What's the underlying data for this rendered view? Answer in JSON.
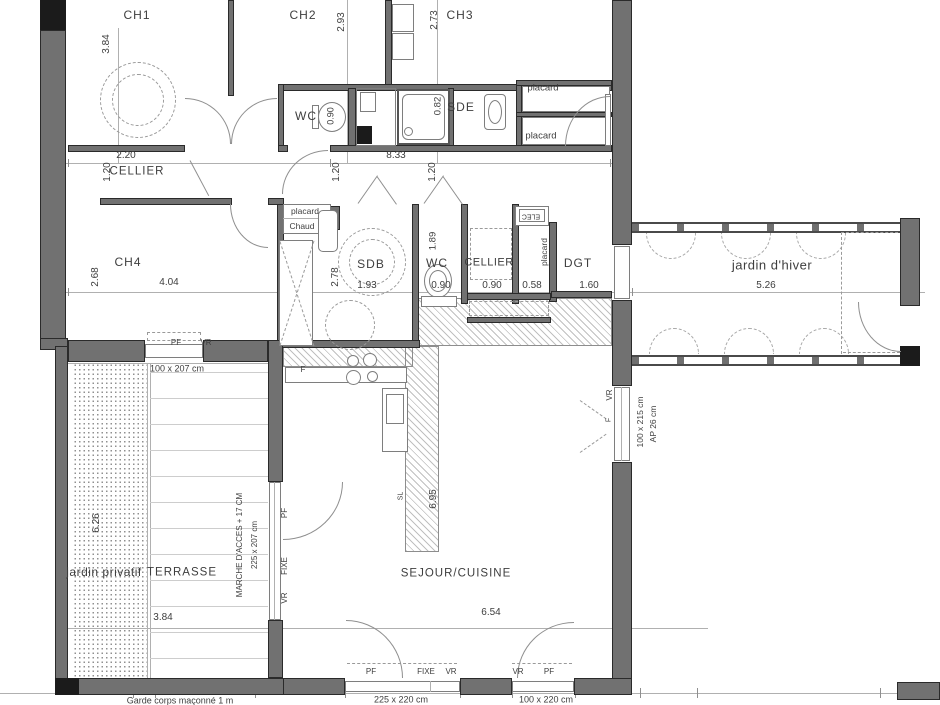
{
  "colors": {
    "wall": "#717171",
    "wall_dark": "#1b1b1b",
    "line": "#b0b0b0",
    "text": "#3e3e3e",
    "background": "#ffffff"
  },
  "plan": {
    "rooms": [
      {
        "n": "room-label-ch1",
        "t": "CH1",
        "x": 137,
        "y": 15,
        "s": 12,
        "ls": 1
      },
      {
        "n": "room-label-ch2",
        "t": "CH2",
        "x": 303,
        "y": 15,
        "s": 12,
        "ls": 1
      },
      {
        "n": "room-label-ch3",
        "t": "CH3",
        "x": 460,
        "y": 15,
        "s": 12,
        "ls": 1
      },
      {
        "n": "room-label-wc-top",
        "t": "WC",
        "x": 306,
        "y": 116,
        "s": 12,
        "ls": 1
      },
      {
        "n": "room-label-sde",
        "t": "SDE",
        "x": 461,
        "y": 107,
        "s": 12,
        "ls": 1
      },
      {
        "n": "room-label-cellier-top",
        "t": "CELLIER",
        "x": 137,
        "y": 172,
        "s": 11.5,
        "ls": 1
      },
      {
        "n": "room-label-ch4",
        "t": "CH4",
        "x": 128,
        "y": 262,
        "s": 12,
        "ls": 1
      },
      {
        "n": "room-label-sdb",
        "t": "SDB",
        "x": 371,
        "y": 264,
        "s": 12,
        "ls": 1
      },
      {
        "n": "room-label-wc-mid",
        "t": "WC",
        "x": 437,
        "y": 263,
        "s": 12,
        "ls": 1
      },
      {
        "n": "room-label-cellier-mid",
        "t": "CELLIER",
        "x": 489,
        "y": 263,
        "s": 11,
        "ls": 0.5
      },
      {
        "n": "room-label-dgt",
        "t": "DGT",
        "x": 578,
        "y": 263,
        "s": 12,
        "ls": 1
      },
      {
        "n": "room-label-jardin-dhiver",
        "t": "jardin d'hiver",
        "x": 772,
        "y": 265,
        "s": 13,
        "ls": 0.5
      },
      {
        "n": "room-label-jardin-privatif",
        "t": "jardin privatif",
        "x": 104,
        "y": 572,
        "s": 12,
        "ls": 0.5
      },
      {
        "n": "room-label-terrasse",
        "t": "TERRASSE",
        "x": 182,
        "y": 573,
        "s": 11.5,
        "ls": 1
      },
      {
        "n": "room-label-sejour-cuisine",
        "t": "SEJOUR/CUISINE",
        "x": 456,
        "y": 574,
        "s": 11.5,
        "ls": 1
      }
    ],
    "closets": [
      {
        "n": "closet-label-placard-1",
        "t": "placard",
        "x": 543,
        "y": 88,
        "s": 9.5
      },
      {
        "n": "closet-label-placard-2",
        "t": "placard",
        "x": 541,
        "y": 136,
        "s": 9.5
      },
      {
        "n": "closet-label-placard-3",
        "t": "placard",
        "x": 305,
        "y": 211,
        "s": 8.5
      },
      {
        "n": "closet-label-chaud",
        "t": "Chaud",
        "x": 302,
        "y": 226,
        "s": 8.5
      },
      {
        "n": "closet-label-placard-4",
        "t": "placard",
        "x": 544,
        "y": 252,
        "s": 8.5,
        "r": -90
      },
      {
        "n": "closet-label-elec",
        "t": "ELEC",
        "x": 531,
        "y": 216,
        "s": 7,
        "r": 180
      }
    ],
    "dimensions": [
      {
        "n": "dim-3-84-top",
        "t": "3.84",
        "x": 107,
        "y": 44,
        "r": -90
      },
      {
        "n": "dim-2-93",
        "t": "2.93",
        "x": 342,
        "y": 22,
        "r": -90
      },
      {
        "n": "dim-2-73",
        "t": "2.73",
        "x": 435,
        "y": 20,
        "r": -90
      },
      {
        "n": "dim-0-90-wc-top",
        "t": "0.90",
        "x": 331,
        "y": 116,
        "r": -90,
        "s": 9
      },
      {
        "n": "dim-0-82",
        "t": "0.82",
        "x": 438,
        "y": 106,
        "r": -90,
        "s": 9.5
      },
      {
        "n": "dim-2-20",
        "t": "2.20",
        "x": 126,
        "y": 156
      },
      {
        "n": "dim-8-33",
        "t": "8.33",
        "x": 396,
        "y": 156
      },
      {
        "n": "dim-1-20-a",
        "t": "1.20",
        "x": 108,
        "y": 172,
        "r": -90
      },
      {
        "n": "dim-1-20-b",
        "t": "1.20",
        "x": 337,
        "y": 172,
        "r": -90
      },
      {
        "n": "dim-1-20-c",
        "t": "1.20",
        "x": 433,
        "y": 172,
        "r": -90
      },
      {
        "n": "dim-2-68",
        "t": "2.68",
        "x": 96,
        "y": 277,
        "r": -90
      },
      {
        "n": "dim-4-04",
        "t": "4.04",
        "x": 169,
        "y": 283
      },
      {
        "n": "dim-2-78",
        "t": "2.78",
        "x": 336,
        "y": 277,
        "r": -90
      },
      {
        "n": "dim-1-93",
        "t": "1.93",
        "x": 367,
        "y": 286
      },
      {
        "n": "dim-1-89",
        "t": "1.89",
        "x": 433,
        "y": 241,
        "r": -90,
        "s": 9.5
      },
      {
        "n": "dim-0-90-b",
        "t": "0.90",
        "x": 441,
        "y": 286
      },
      {
        "n": "dim-0-90-c",
        "t": "0.90",
        "x": 492,
        "y": 286
      },
      {
        "n": "dim-0-58",
        "t": "0.58",
        "x": 532,
        "y": 286
      },
      {
        "n": "dim-1-60",
        "t": "1.60",
        "x": 589,
        "y": 286
      },
      {
        "n": "dim-5-26",
        "t": "5.26",
        "x": 766,
        "y": 286
      },
      {
        "n": "dim-6-26",
        "t": "6.26",
        "x": 97,
        "y": 523,
        "r": -90
      },
      {
        "n": "dim-3-84-bottom",
        "t": "3.84",
        "x": 163,
        "y": 618
      },
      {
        "n": "dim-6-95",
        "t": "6.95",
        "x": 434,
        "y": 499,
        "r": -90
      },
      {
        "n": "dim-6-54",
        "t": "6.54",
        "x": 491,
        "y": 613
      }
    ],
    "openings": [
      {
        "n": "opening-label-pf-1",
        "t": "PF",
        "x": 176,
        "y": 343,
        "s": 8
      },
      {
        "n": "opening-label-vr-1",
        "t": "VR",
        "x": 206,
        "y": 343,
        "s": 8
      },
      {
        "n": "opening-size-100x207",
        "t": "100 x 207 cm",
        "x": 177,
        "y": 369,
        "s": 9
      },
      {
        "n": "annotation-marche-acces",
        "t": "MARCHE D'ACCES + 17 CM",
        "x": 240,
        "y": 545,
        "r": -90,
        "s": 8
      },
      {
        "n": "opening-size-225x207",
        "t": "225 x 207 cm",
        "x": 255,
        "y": 545,
        "r": -90,
        "s": 8
      },
      {
        "n": "opening-label-pf-v",
        "t": "PF",
        "x": 285,
        "y": 513,
        "r": -90,
        "s": 8
      },
      {
        "n": "opening-label-fixe-v",
        "t": "FIXE",
        "x": 285,
        "y": 566,
        "r": -90,
        "s": 8
      },
      {
        "n": "opening-label-vr-v",
        "t": "VR",
        "x": 285,
        "y": 598,
        "r": -90,
        "s": 8
      },
      {
        "n": "opening-label-vr-window",
        "t": "VR",
        "x": 610,
        "y": 395,
        "r": -90,
        "s": 8
      },
      {
        "n": "opening-label-f-window",
        "t": "F",
        "x": 609,
        "y": 420,
        "r": -90,
        "s": 7
      },
      {
        "n": "opening-size-100x215",
        "t": "100 x 215 cm",
        "x": 640,
        "y": 422,
        "r": -90,
        "s": 8.5
      },
      {
        "n": "opening-size-ap-26",
        "t": "AP 26 cm",
        "x": 653,
        "y": 424,
        "r": -90,
        "s": 8.5
      },
      {
        "n": "opening-label-pf-2",
        "t": "PF",
        "x": 371,
        "y": 672,
        "s": 8
      },
      {
        "n": "opening-label-fixe-2",
        "t": "FIXE",
        "x": 426,
        "y": 672,
        "s": 8
      },
      {
        "n": "opening-label-vr-2",
        "t": "VR",
        "x": 451,
        "y": 672,
        "s": 8
      },
      {
        "n": "opening-label-vr-3",
        "t": "VR",
        "x": 518,
        "y": 672,
        "s": 8
      },
      {
        "n": "opening-label-pf-3",
        "t": "PF",
        "x": 549,
        "y": 672,
        "s": 8
      },
      {
        "n": "opening-size-225x220",
        "t": "225 x 220 cm",
        "x": 401,
        "y": 700,
        "s": 9
      },
      {
        "n": "opening-size-100x220",
        "t": "100 x 220 cm",
        "x": 546,
        "y": 700,
        "s": 9
      }
    ],
    "annotations": [
      {
        "n": "annotation-f-fridge",
        "t": "F",
        "x": 303,
        "y": 370,
        "s": 8
      },
      {
        "n": "annotation-sl",
        "t": "SL",
        "x": 401,
        "y": 496,
        "r": -90,
        "s": 7
      },
      {
        "n": "annotation-garde-corps",
        "t": "Garde corps maçonné 1 m",
        "x": 180,
        "y": 701,
        "s": 9
      }
    ]
  }
}
